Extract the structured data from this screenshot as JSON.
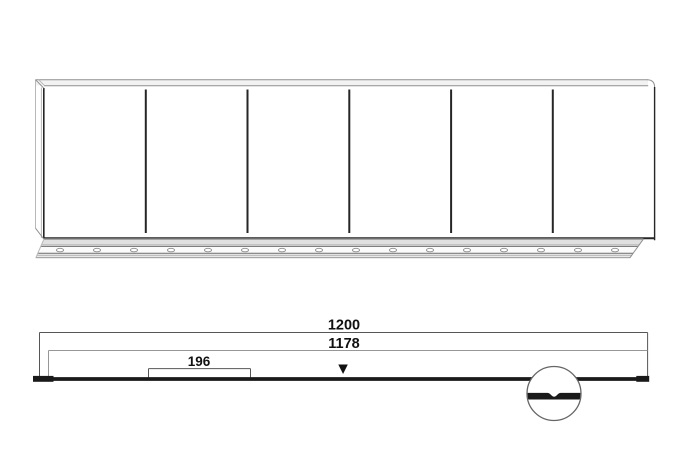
{
  "diagram": {
    "type": "furniture-panel-technical-drawing",
    "dimensions": {
      "overall_width_label": "1200",
      "rail_width_label": "1178",
      "section_width_label": "196"
    },
    "marker": {
      "down_triangle": "▼"
    },
    "panel": {
      "section_count": 6
    },
    "rail": {
      "slot_count": 16,
      "slot_start_x": 60,
      "slot_spacing": 37
    },
    "colors": {
      "background": "#ffffff",
      "line_dark": "#262626",
      "line_mid": "#6e6e6e",
      "line_gray": "#8f8f8f",
      "line_light": "#b8b8b8",
      "bar_black": "#1a1a1a",
      "text": "#111111",
      "band_fill": "#f2f2f2",
      "rail_fill": "#e9e9e9"
    }
  }
}
